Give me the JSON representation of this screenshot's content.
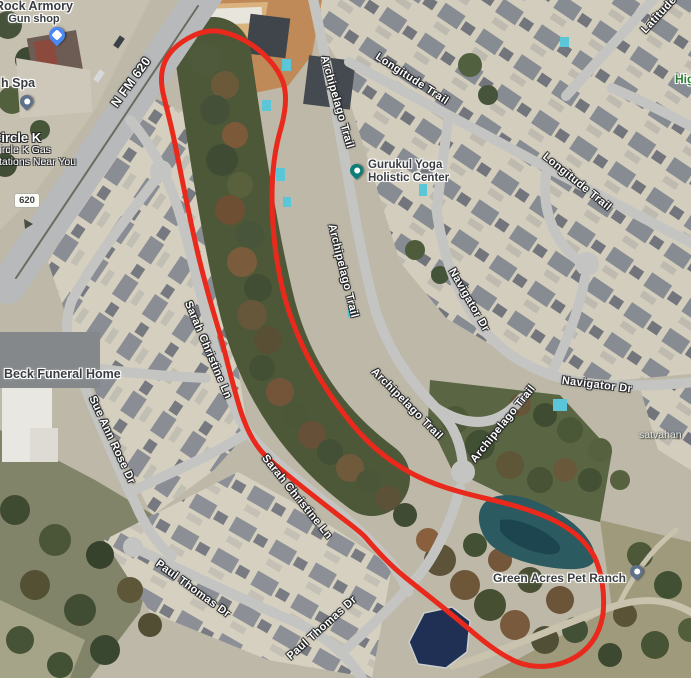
{
  "map": {
    "view_type": "satellite",
    "annotation": {
      "type": "freehand-loop",
      "color": "#e8291c",
      "purpose": "outlines greenbelt area between Sarah Christine Ln and Archipelago Trail down to the pond"
    },
    "water_colors": {
      "large_pond": "#2b5a60",
      "retention_pond": "#1f3054",
      "pools": "#5ac6d8"
    }
  },
  "route_shield": {
    "text": "620"
  },
  "road_labels": [
    {
      "text": "N FM 620"
    },
    {
      "text": "Latitude"
    },
    {
      "text": "Longitude Trail"
    },
    {
      "text": "Longitude Trail"
    },
    {
      "text": "Archipelago Trail"
    },
    {
      "text": "Archipelago Trail"
    },
    {
      "text": "Archipelago Trail"
    },
    {
      "text": "Archipelago Trail"
    },
    {
      "text": "Navigator Dr"
    },
    {
      "text": "Navigator Dr"
    },
    {
      "text": "Sarah Christine Ln"
    },
    {
      "text": "Sarah Christine Ln"
    },
    {
      "text": "Sue Ann Rose Dr"
    },
    {
      "text": "Paul Thomas Dr"
    },
    {
      "text": "Paul Thomas Dr"
    }
  ],
  "pois": [
    {
      "line1": "Rock Armory",
      "line2": "Gun shop",
      "pin_color": "#4a89f4"
    },
    {
      "line1": "h Spa",
      "pin_color": "#60728a"
    },
    {
      "line1": "Circle K",
      "line2": "Circle K Gas",
      "line3": "Stations Near You"
    },
    {
      "line1": "Beck Funeral Home"
    },
    {
      "line1": "Gurukul Yoga",
      "line2": "Holistic Center",
      "pin_color": "#0e7d78"
    },
    {
      "line1": "Green Acres Pet Ranch",
      "pin_color": "#60728a"
    },
    {
      "line1": "satvahan"
    },
    {
      "line1": "Hig"
    }
  ]
}
